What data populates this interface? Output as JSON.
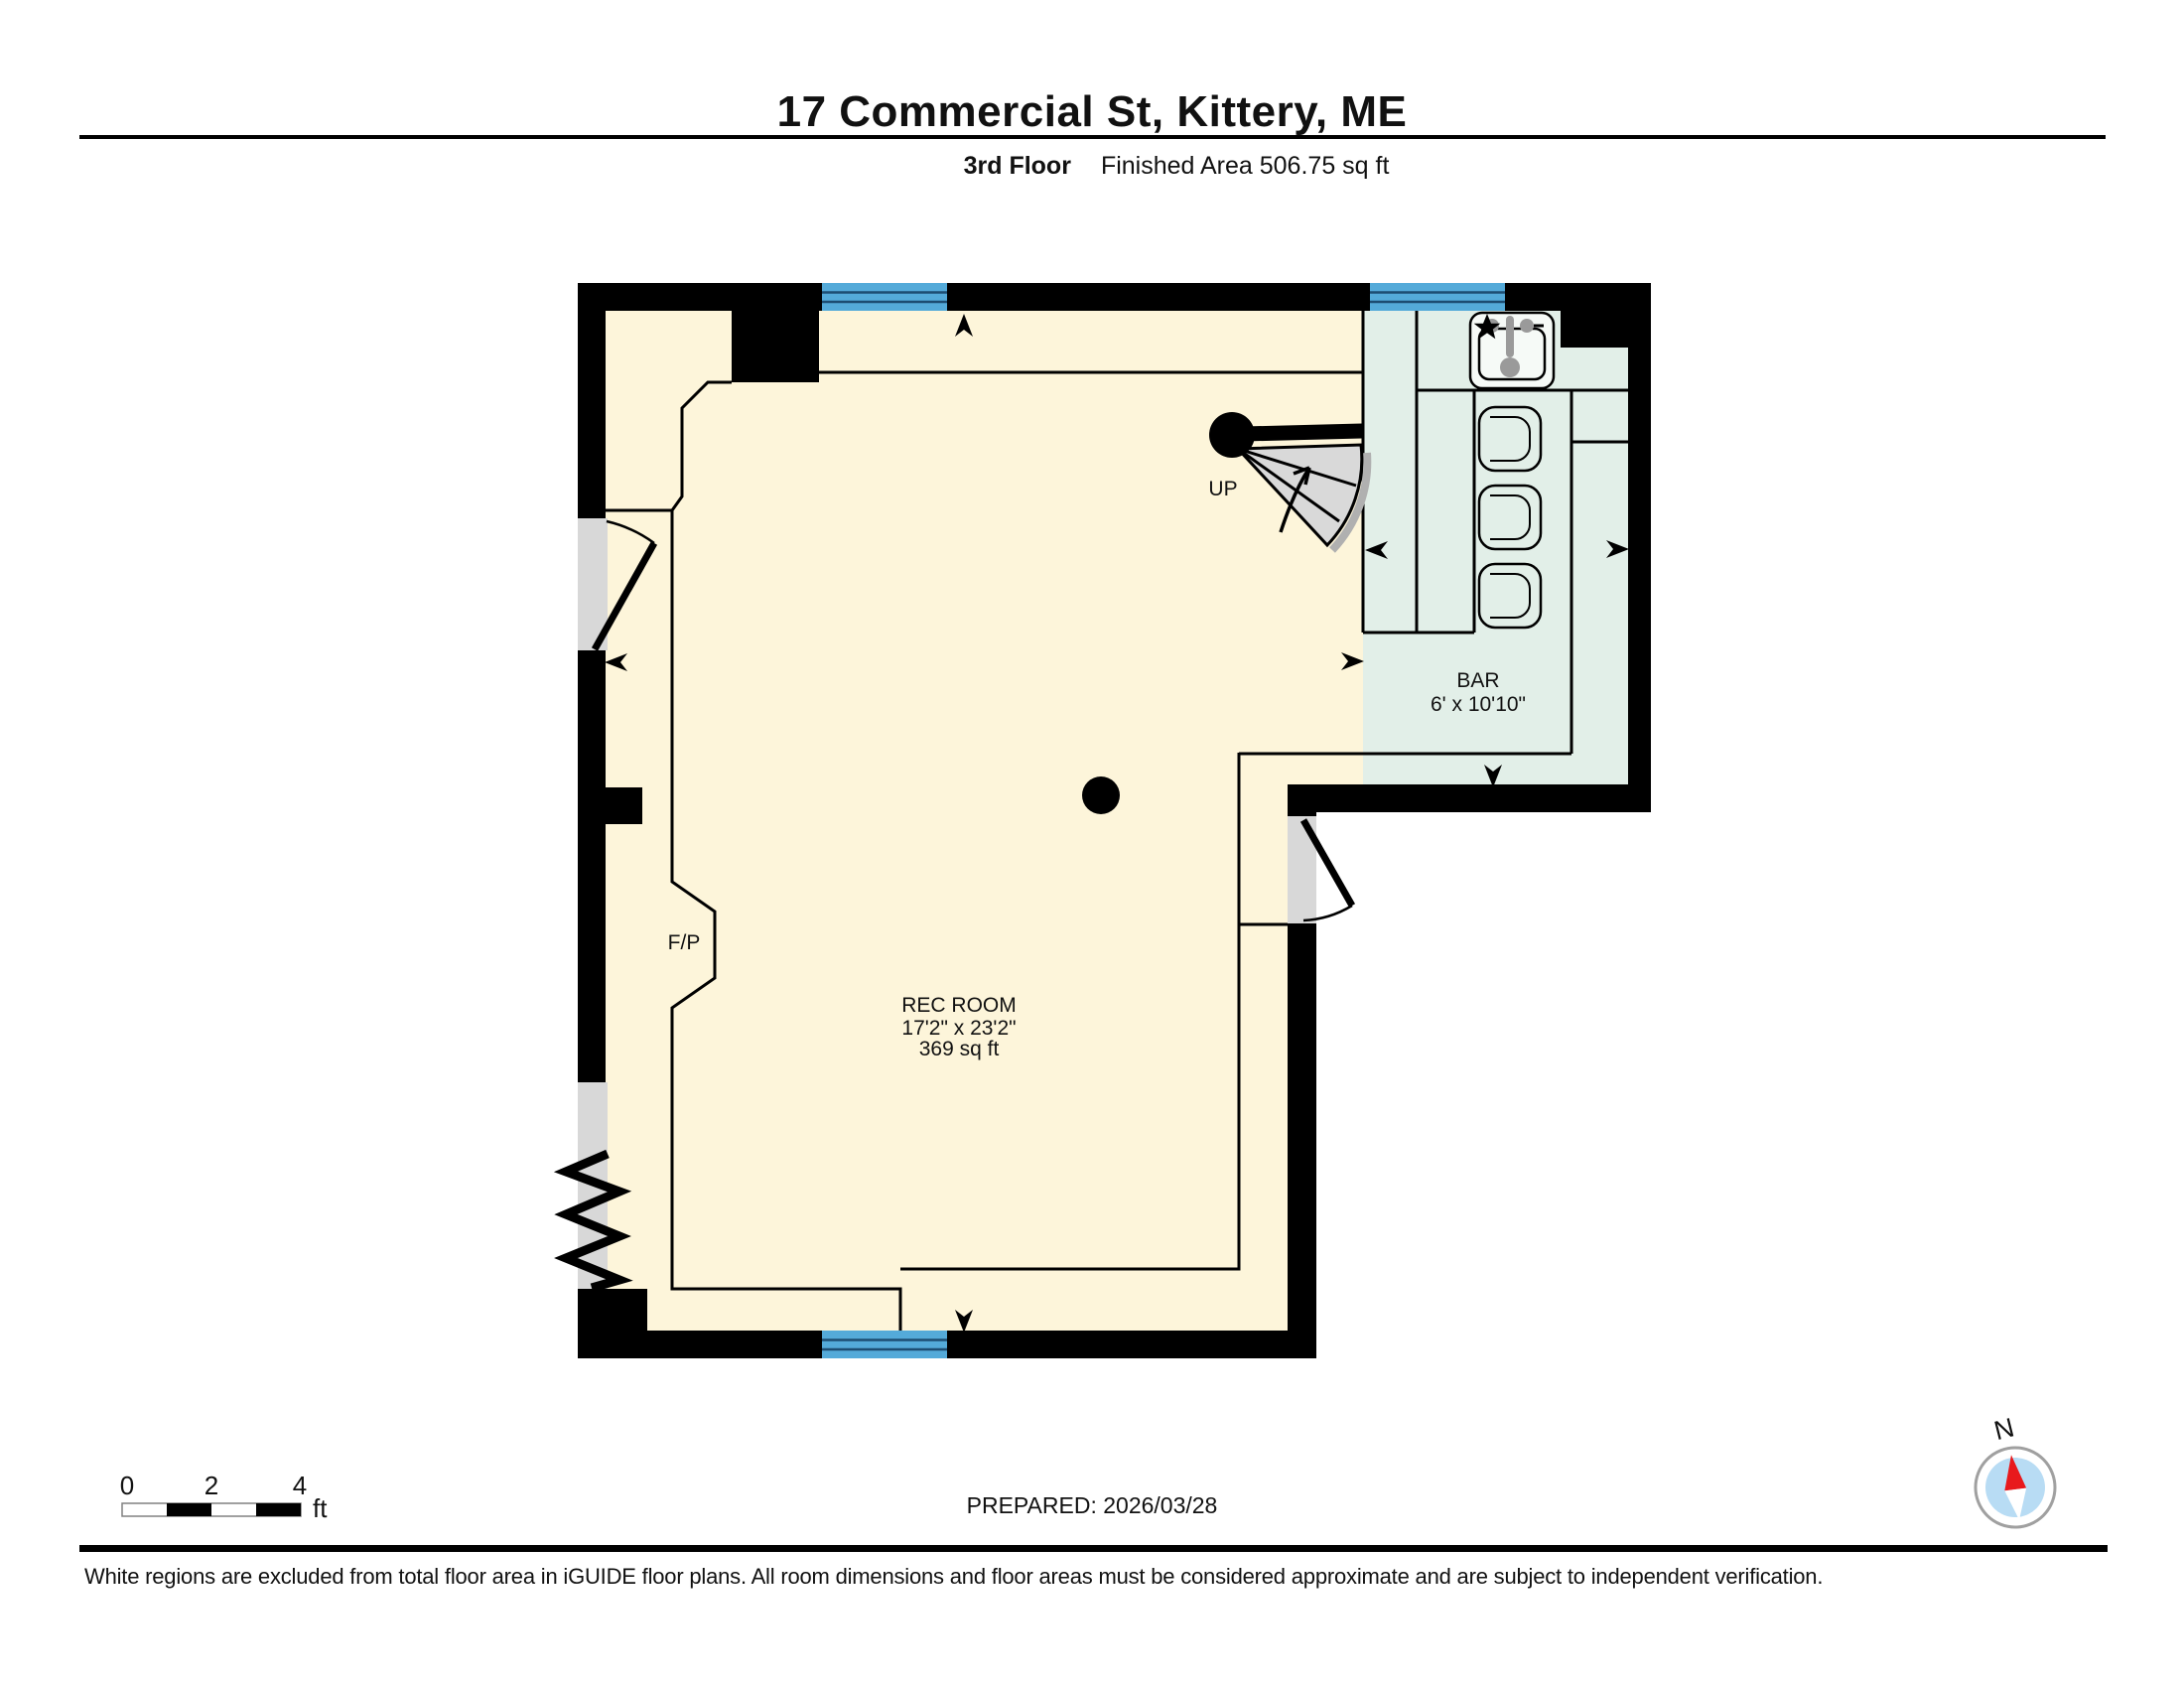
{
  "theme": {
    "floor_fill": "#fdf5da",
    "bar_fill": "#e2efe8",
    "window_blue": "#54aad9",
    "window_line": "#1d4d72",
    "door_gray": "#d8d8d8",
    "wall_black": "#000000",
    "stair_gray": "#d9d9d9",
    "compass_red": "#e8191c",
    "compass_blue": "#b8dcf4"
  },
  "header": {
    "title": "17 Commercial St, Kittery, ME",
    "floor_label": "3rd Floor",
    "area_label": "Finished Area 506.75 sq ft"
  },
  "plan": {
    "rec_room": {
      "name": "REC ROOM",
      "dimensions": "17'2\" x 23'2\"",
      "area": "369 sq ft"
    },
    "bar": {
      "name": "BAR",
      "dimensions": "6' x 10'10\""
    },
    "stairs_label": "UP",
    "fireplace_label": "F/P"
  },
  "scale_bar": {
    "tick_0": "0",
    "tick_2": "2",
    "tick_4": "4",
    "unit": "ft"
  },
  "prepared_text": "PREPARED: 2026/03/28",
  "compass": {
    "north_label": "N"
  },
  "footer": {
    "disclaimer": "White regions are excluded from total floor area in iGUIDE floor plans. All room dimensions and floor areas must be considered approximate and are subject to independent verification."
  }
}
